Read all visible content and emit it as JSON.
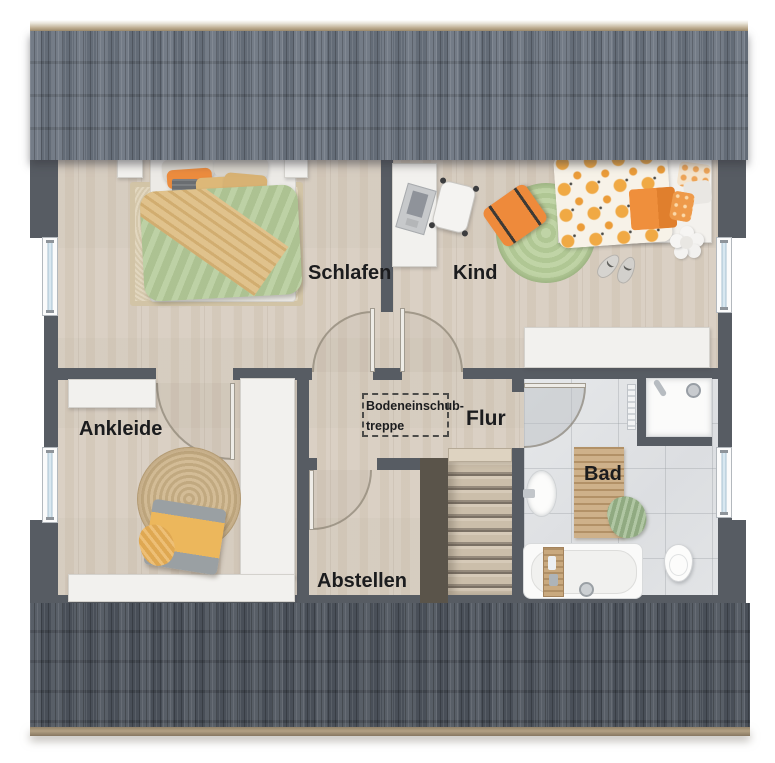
{
  "rooms": {
    "schlafen": {
      "label": "Schlafen"
    },
    "kind": {
      "label": "Kind"
    },
    "ankleide": {
      "label": "Ankleide"
    },
    "flur": {
      "label": "Flur"
    },
    "abstellen": {
      "label": "Abstellen"
    },
    "bad": {
      "label": "Bad"
    }
  },
  "annotations": {
    "attic_stairs": {
      "line1": "Bodeneinschub-",
      "line2": "treppe"
    }
  },
  "colors": {
    "wall": "#575c63",
    "roof_top": "#6b7480",
    "roof_bottom": "#4f565f",
    "roof_edge": "#b2a083",
    "wood_floor": "#d8cec1",
    "tile_floor": "#e1e3e5",
    "accent_orange": "#ec8c3e",
    "accent_green": "#b6cc9c",
    "accent_tan": "#dcb97c"
  }
}
